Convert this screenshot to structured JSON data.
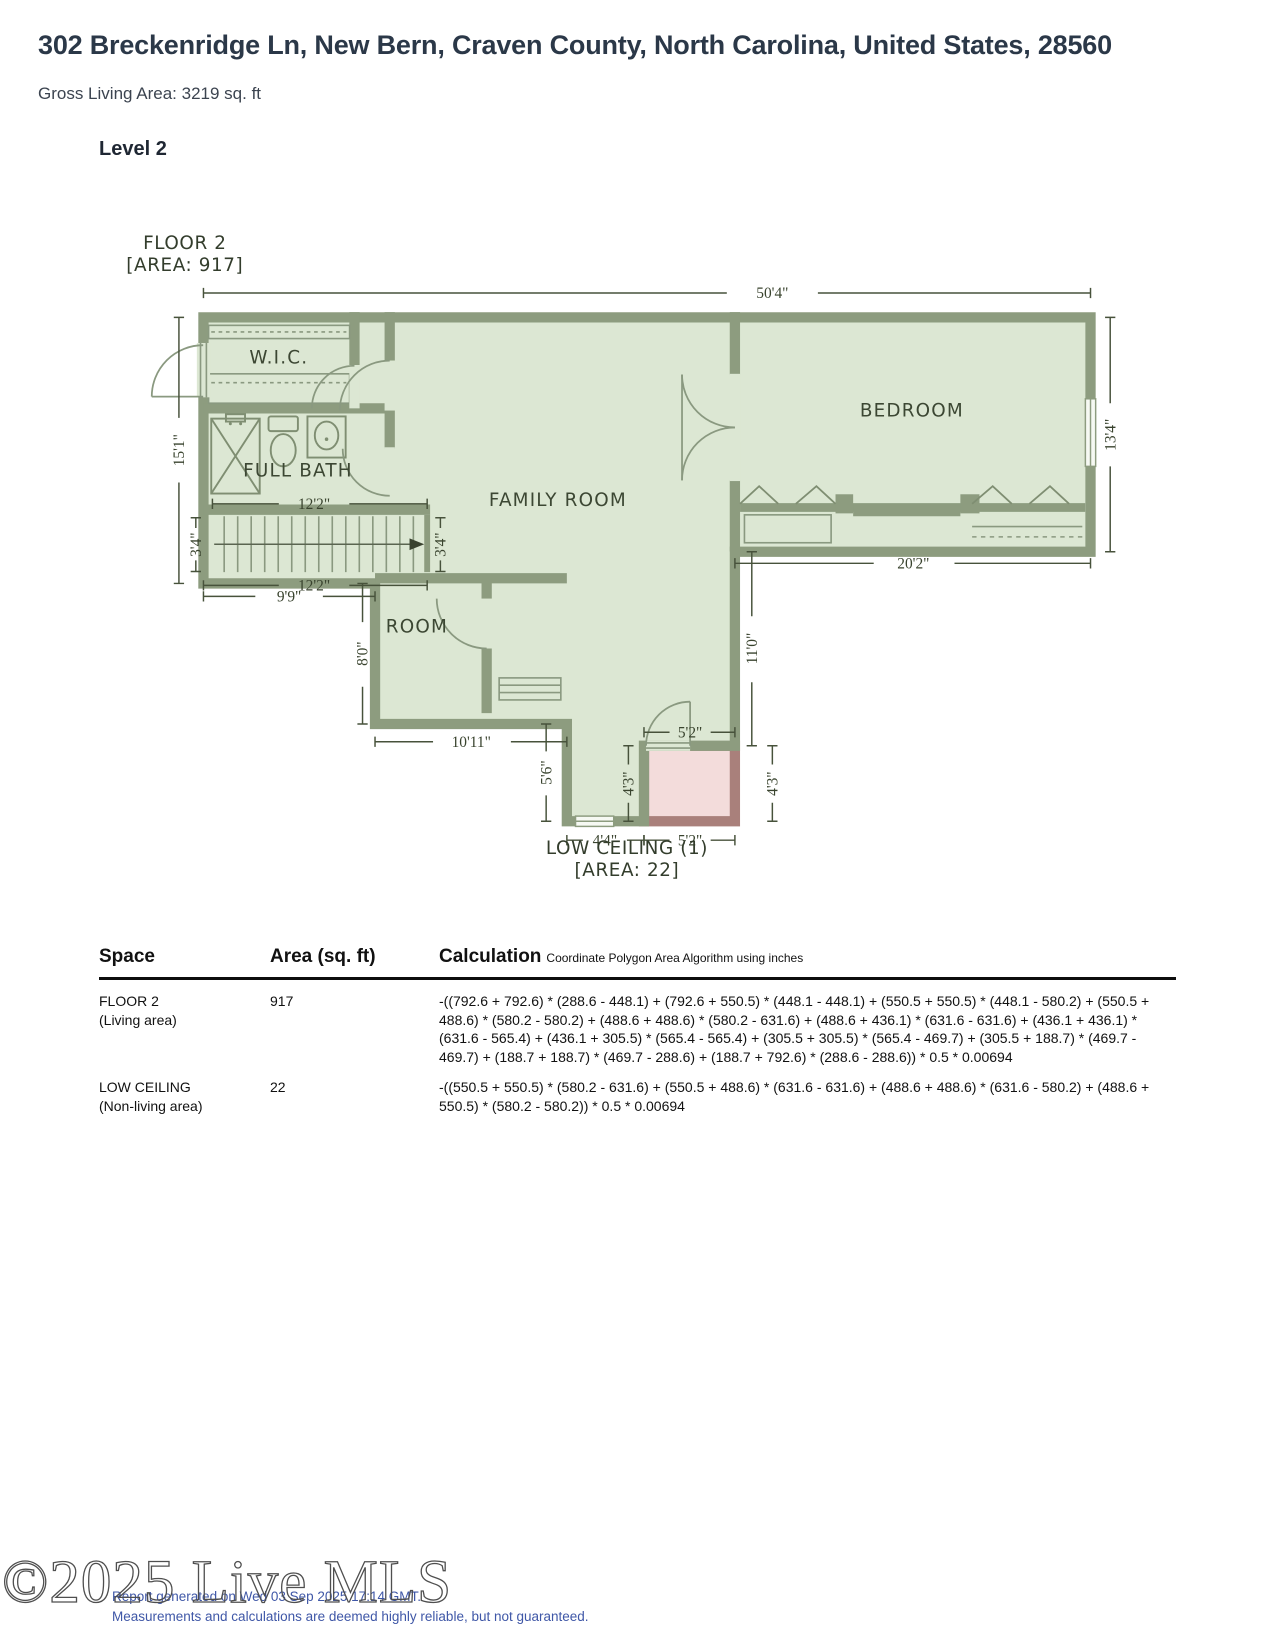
{
  "header": {
    "title": "302 Breckenridge Ln, New Bern, Craven County, North Carolina, United States, 28560",
    "subtitle": "Gross Living Area: 3219 sq. ft",
    "level": "Level 2"
  },
  "plan": {
    "floor_label": "FLOOR 2",
    "floor_area_label": "[AREA: 917]",
    "low_ceiling_label": "LOW CEILING (1)",
    "low_ceiling_area_label": "[AREA: 22]",
    "rooms": {
      "wic": "W.I.C.",
      "full_bath": "FULL BATH",
      "family_room": "FAMILY ROOM",
      "bedroom": "BEDROOM",
      "room": "ROOM"
    },
    "dims": {
      "total_width": "50'4\"",
      "left_height": "15'1\"",
      "bath_width": "12'2\"",
      "stairs_width": "12'2\"",
      "stairs_height_left": "3'4\"",
      "stairs_height_right": "3'4\"",
      "landing_width": "9'9\"",
      "bedroom_height": "13'4\"",
      "bedroom_width": "20'2\"",
      "room_height": "8'0\"",
      "room_width": "10'11\"",
      "corridor_height": "5'6\"",
      "stem_height": "11'0\"",
      "low_top_width": "5'2\"",
      "low_bottom_width": "5'2\"",
      "low_height_left": "4'3\"",
      "low_height_right": "4'3\"",
      "entry_width": "4'4\""
    },
    "colors": {
      "wall": "#8d9c7f",
      "floor": "#dce7d3",
      "low_ceiling_fill": "#f3dcdb",
      "low_ceiling_wall": "#a9807b",
      "dimension": "#47523b"
    }
  },
  "table": {
    "headers": {
      "space": "Space",
      "area": "Area (sq. ft)",
      "calculation": "Calculation",
      "calculation_note": "Coordinate Polygon Area Algorithm using inches"
    },
    "rows": [
      {
        "space": "FLOOR 2",
        "space_note": "(Living area)",
        "area": "917",
        "calculation": "-((792.6 + 792.6) * (288.6 - 448.1) + (792.6 + 550.5) * (448.1 - 448.1) + (550.5 + 550.5) * (448.1 - 580.2) + (550.5 + 488.6) * (580.2 - 580.2) + (488.6 + 488.6) * (580.2 - 631.6) + (488.6 + 436.1) * (631.6 - 631.6) + (436.1 + 436.1) * (631.6 - 565.4) + (436.1 + 305.5) * (565.4 - 565.4) + (305.5 + 305.5) * (565.4 - 469.7) + (305.5 + 188.7) * (469.7 - 469.7) + (188.7 + 188.7) * (469.7 - 288.6) + (188.7 + 792.6) * (288.6 - 288.6)) * 0.5 * 0.00694"
      },
      {
        "space": "LOW CEILING",
        "space_note": "(Non-living area)",
        "area": "22",
        "calculation": "-((550.5 + 550.5) * (580.2 - 631.6) + (550.5 + 488.6) * (631.6 - 631.6) + (488.6 + 488.6) * (631.6 - 580.2) + (488.6 + 550.5) * (580.2 - 580.2)) * 0.5 * 0.00694"
      }
    ]
  },
  "footer": {
    "watermark": "©2025 Live MLS",
    "generated": "Report generated on Wed 03 Sep 2025 17:14 GMT.",
    "disclaimer": "Measurements and calculations are deemed highly reliable, but not guaranteed."
  }
}
